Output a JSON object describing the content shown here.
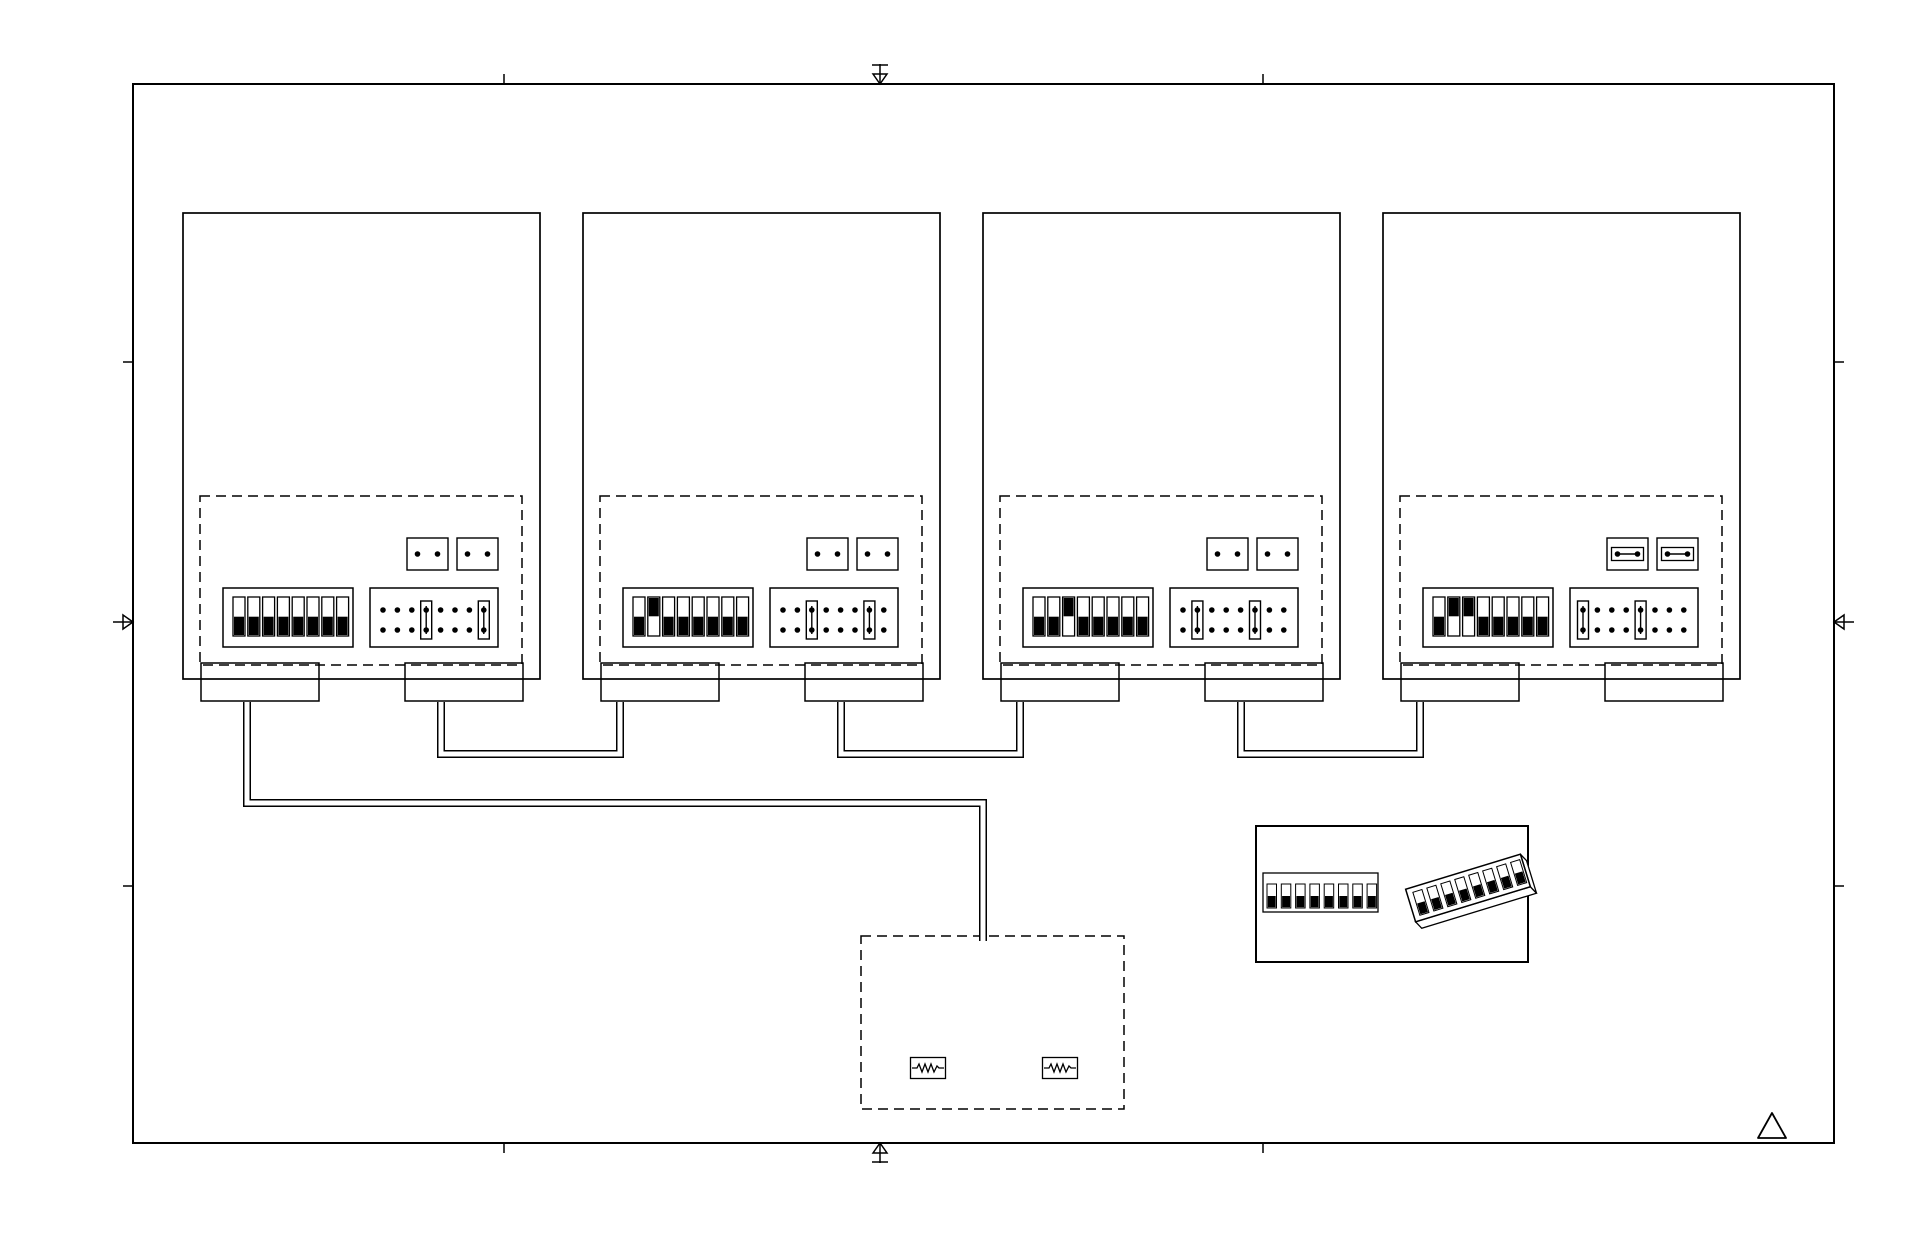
{
  "sheet": {
    "width": 1908,
    "height": 1235,
    "background": "#ffffff",
    "ink": "#000000"
  },
  "frame": {
    "x": 133,
    "y": 84,
    "width": 1701,
    "height": 1059,
    "edge_ticks": {
      "top_x": [
        504,
        1263
      ],
      "bottom_x": [
        504,
        1263
      ],
      "left_y": [
        362,
        886
      ],
      "right_y": [
        362,
        886
      ],
      "length": 10
    },
    "center_marks": {
      "top_x": 880,
      "bottom_x": 880,
      "left_y": 622,
      "right_y": 622
    }
  },
  "unit_template": {
    "width": 357,
    "top": 213,
    "height": 466,
    "dashed_zone": {
      "dx": 17,
      "y": 496,
      "width": 322,
      "height": 169
    },
    "dip_block": {
      "dx": 40,
      "y": 588,
      "width": 130,
      "height": 59,
      "first_switch_dx": 50,
      "switch_pitch": 14.8,
      "switch_width": 12,
      "switch_top": 597,
      "switch_height": 39
    },
    "jumper_block": {
      "dx": 187,
      "y": 588,
      "width": 128,
      "height": 59,
      "first_col_dx": 200,
      "col_pitch": 14.4,
      "row_y": [
        610,
        630
      ],
      "dot_r": 2.8,
      "shunt_top": 601,
      "shunt_height": 38,
      "shunt_width": 11
    },
    "aux_boxes": {
      "dx": [
        224,
        274
      ],
      "y": 538,
      "width": 41,
      "height": 32,
      "dot_dx": 10,
      "dot_y": 554
    },
    "tabs": {
      "left_dx": 18,
      "right_dx": 222,
      "width": 118,
      "top": 663,
      "bottom": 701
    }
  },
  "units": [
    {
      "id": "device-unit-1",
      "x": 183,
      "dip_up": [],
      "jumper_columns": [
        4,
        8
      ],
      "aux_jumpers": false
    },
    {
      "id": "device-unit-2",
      "x": 583,
      "dip_up": [
        2
      ],
      "jumper_columns": [
        3,
        7
      ],
      "aux_jumpers": false
    },
    {
      "id": "device-unit-3",
      "x": 983,
      "dip_up": [
        3
      ],
      "jumper_columns": [
        2,
        6
      ],
      "aux_jumpers": false
    },
    {
      "id": "device-unit-4",
      "x": 1383,
      "dip_up": [
        2,
        3
      ],
      "jumper_columns": [
        1,
        5
      ],
      "aux_jumpers": true
    }
  ],
  "cables": [
    {
      "id": "cable-unit1-to-terminator-box",
      "points": [
        [
          247,
          702
        ],
        [
          247,
          803
        ],
        [
          983,
          803
        ],
        [
          983,
          941
        ]
      ]
    },
    {
      "id": "cable-unit1-to-unit2",
      "points": [
        [
          441,
          702
        ],
        [
          441,
          754
        ],
        [
          620,
          754
        ],
        [
          620,
          702
        ]
      ]
    },
    {
      "id": "cable-unit2-to-unit3",
      "points": [
        [
          841,
          702
        ],
        [
          841,
          754
        ],
        [
          1020,
          754
        ],
        [
          1020,
          702
        ]
      ]
    },
    {
      "id": "cable-unit3-to-unit4",
      "points": [
        [
          1241,
          702
        ],
        [
          1241,
          754
        ],
        [
          1420,
          754
        ],
        [
          1420,
          702
        ]
      ]
    }
  ],
  "terminator_box": {
    "x": 861,
    "y": 936,
    "width": 263,
    "height": 173,
    "resistors": [
      {
        "cx": 928,
        "cy": 1068
      },
      {
        "cx": 1060,
        "cy": 1068
      }
    ]
  },
  "detail_inset": {
    "x": 1256,
    "y": 826,
    "width": 272,
    "height": 136,
    "flat_dip": {
      "x": 1263,
      "y": 873,
      "width": 115,
      "height": 39,
      "first_switch_x": 1267,
      "pitch": 14.3,
      "switch_width": 9.5,
      "switch_top": 884,
      "switch_height": 24,
      "switch_count": 8,
      "up": []
    },
    "rotated_dip": {
      "body_x": 1408,
      "body_y": 871,
      "length": 120,
      "thickness": 34,
      "first_switch_x": 1414,
      "pitch": 14.6,
      "switch_width": 9.5,
      "switch_top": 876,
      "switch_height": 24,
      "switch_count": 8,
      "up": [],
      "angle": -17,
      "pivot_x": 1468,
      "pivot_y": 888,
      "depth": 8
    }
  },
  "revision_triangle": {
    "cx": 1772,
    "top_y": 1113,
    "bottom_y": 1138,
    "half_width": 14
  }
}
